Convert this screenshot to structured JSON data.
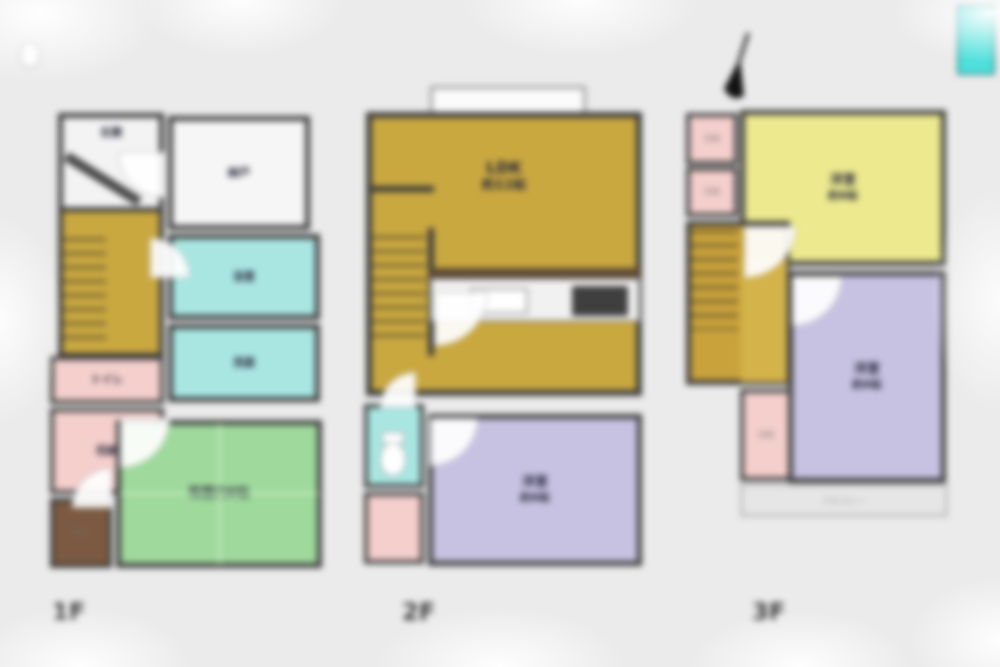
{
  "colors": {
    "wall": "#3c3c3c",
    "hall_yellow": "#c9a840",
    "pale_yellow_room": "#ece98e",
    "purple_room": "#c7c2e2",
    "tatami_green": "#9fd99c",
    "wet_area_teal": "#a9e6e2",
    "bathtub_teal": "#4fe0dc",
    "closet_pink": "#f4cfcc",
    "oshiire_brown": "#7c5a41",
    "background": "#ebebeb"
  },
  "floor1": {
    "tag": "1F",
    "genkan": "玄関",
    "nando": "納戸",
    "bath": "浴室",
    "senmen": "洗面",
    "toilet": "トイレ",
    "closet": "収納",
    "oshiire": "押入",
    "washitsu": "和室約6帖"
  },
  "floor2": {
    "tag": "2F",
    "ldk": "LDK",
    "ldk_size": "約11帖",
    "bedroom": "洋室",
    "bedroom_size": "約6帖"
  },
  "floor3": {
    "tag": "3F",
    "bedroom1": "洋室",
    "bedroom1_size": "約6帖",
    "bedroom2": "洋室",
    "bedroom2_size": "約6帖",
    "closet1": "収納",
    "closet2": "収納",
    "closet3": "収納",
    "balcony": "バルコニー"
  }
}
